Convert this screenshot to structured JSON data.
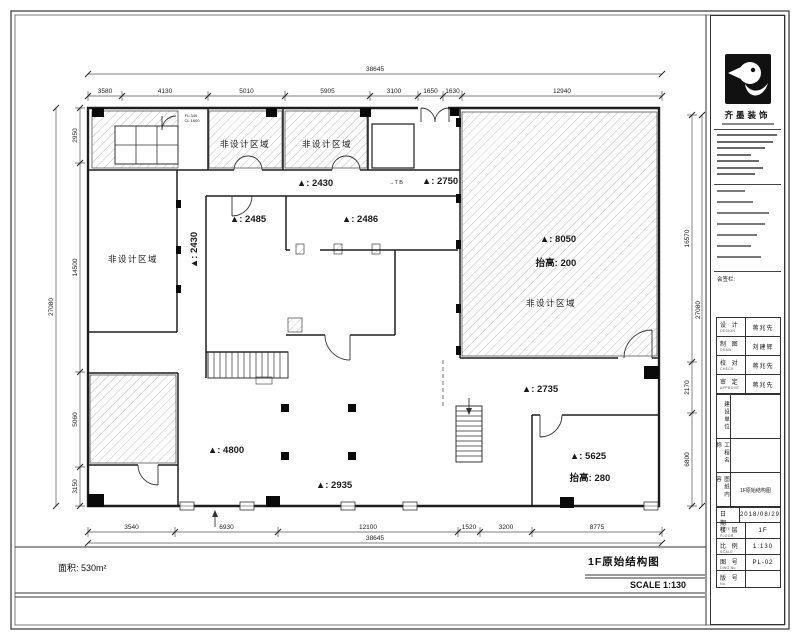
{
  "page": {
    "area_text": "面积: 530m²",
    "drawing_title": "1F原始结构图",
    "scale_text": "SCALE 1:130"
  },
  "titleblock": {
    "company_name": "齐墨装饰",
    "sign_section": "会签栏:",
    "approval_rows": [
      {
        "label": "设 计",
        "sub": "DESIGN",
        "value": "蒋兆先"
      },
      {
        "label": "制 图",
        "sub": "DRAW",
        "value": "刘建辉"
      },
      {
        "label": "校 对",
        "sub": "CHECK",
        "value": "蒋兆先"
      },
      {
        "label": "审 定",
        "sub": "APPROVE",
        "value": "蒋兆先"
      }
    ],
    "vert_rows": [
      {
        "label": "建设单位",
        "value": ""
      },
      {
        "label": "工程名称",
        "value": ""
      },
      {
        "label": "图纸内容",
        "value": "1F原始结构图"
      }
    ],
    "meta_rows": [
      {
        "label": "日 期",
        "sub": "DATE",
        "value": "2018/08/29"
      },
      {
        "label": "楼 层",
        "sub": "FLOOR",
        "value": "1F"
      },
      {
        "label": "比 例",
        "sub": "SCALE",
        "value": "1:130"
      },
      {
        "label": "图 号",
        "sub": "DWG.No",
        "value": "PL-02"
      },
      {
        "label": "版 号",
        "sub": "No.",
        "value": ""
      }
    ]
  },
  "plan": {
    "annotations": [
      {
        "text": "非设计区域",
        "x": 245,
        "y": 147,
        "size": 8.5,
        "ls": 1.5
      },
      {
        "text": "非设计区域",
        "x": 327,
        "y": 147,
        "size": 8.5,
        "ls": 1.5
      },
      {
        "text": "非设计区域",
        "x": 133,
        "y": 262,
        "size": 8.5,
        "ls": 1.5
      },
      {
        "text": "▲: 2430",
        "x": 197,
        "y": 250,
        "size": 9.5,
        "rot": -90,
        "bold": 1
      },
      {
        "text": "▲: 2430",
        "x": 315,
        "y": 186,
        "size": 9.5,
        "bold": 1
      },
      {
        "text": "▲: 2750",
        "x": 440,
        "y": 184,
        "size": 9.5,
        "bold": 1
      },
      {
        "text": "▲: 2485",
        "x": 248,
        "y": 222,
        "size": 9.5,
        "bold": 1
      },
      {
        "text": "▲: 2486",
        "x": 360,
        "y": 222,
        "size": 9.5,
        "bold": 1
      },
      {
        "text": "▲: 8050",
        "x": 558,
        "y": 242,
        "size": 9.5,
        "bold": 1
      },
      {
        "text": "抬高: 200",
        "x": 556,
        "y": 266,
        "size": 9.5,
        "bold": 1
      },
      {
        "text": "非设计区域",
        "x": 551,
        "y": 306,
        "size": 8.5,
        "ls": 1.5
      },
      {
        "text": "▲: 2735",
        "x": 540,
        "y": 392,
        "size": 9.5,
        "bold": 1
      },
      {
        "text": "▲: 5625",
        "x": 588,
        "y": 459,
        "size": 9.5,
        "bold": 1
      },
      {
        "text": "抬高: 280",
        "x": 590,
        "y": 481,
        "size": 9.5,
        "bold": 1
      },
      {
        "text": "▲: 4800",
        "x": 226,
        "y": 453,
        "size": 9.5,
        "bold": 1
      },
      {
        "text": "▲: 2935",
        "x": 334,
        "y": 488,
        "size": 9.5,
        "bold": 1
      },
      {
        "text": "FL:340",
        "x": 191,
        "y": 117,
        "size": 4
      },
      {
        "text": "CL:1600",
        "x": 192,
        "y": 122,
        "size": 4
      },
      {
        "text": "→T B",
        "x": 396,
        "y": 184,
        "size": 5.5
      }
    ],
    "dims": {
      "top": {
        "orient": "h",
        "chain": 96,
        "total_line": 74,
        "bounds": [
          88,
          122,
          208,
          285,
          370,
          418,
          443,
          462,
          662
        ],
        "labels": [
          "3580",
          "4130",
          "5010",
          "5905",
          "3100",
          "1650",
          "1630",
          "12940"
        ],
        "total": "38645",
        "total_pos": [
          375,
          71
        ]
      },
      "bottom": {
        "orient": "h",
        "chain": 532,
        "total_line": 543,
        "bounds": [
          88,
          175,
          278,
          458,
          480,
          532,
          662
        ],
        "labels": [
          "3540",
          "6930",
          "12100",
          "1520",
          "3200",
          "8775"
        ],
        "total": "38645",
        "total_pos": [
          375,
          540
        ]
      },
      "left": {
        "orient": "v",
        "chain": 80,
        "total_line": 56,
        "bounds": [
          108,
          163,
          372,
          467,
          506
        ],
        "labels": [
          "2950",
          "14500",
          "5060",
          "3150"
        ],
        "total": "27080",
        "total_pos": [
          53,
          307
        ]
      },
      "right": {
        "orient": "v",
        "chain": 692,
        "total_line": 702,
        "bounds": [
          115,
          362,
          413,
          506
        ],
        "labels": [
          "16570",
          "2170",
          "6800"
        ],
        "total": "27080",
        "total_pos": [
          700,
          310
        ]
      }
    }
  }
}
